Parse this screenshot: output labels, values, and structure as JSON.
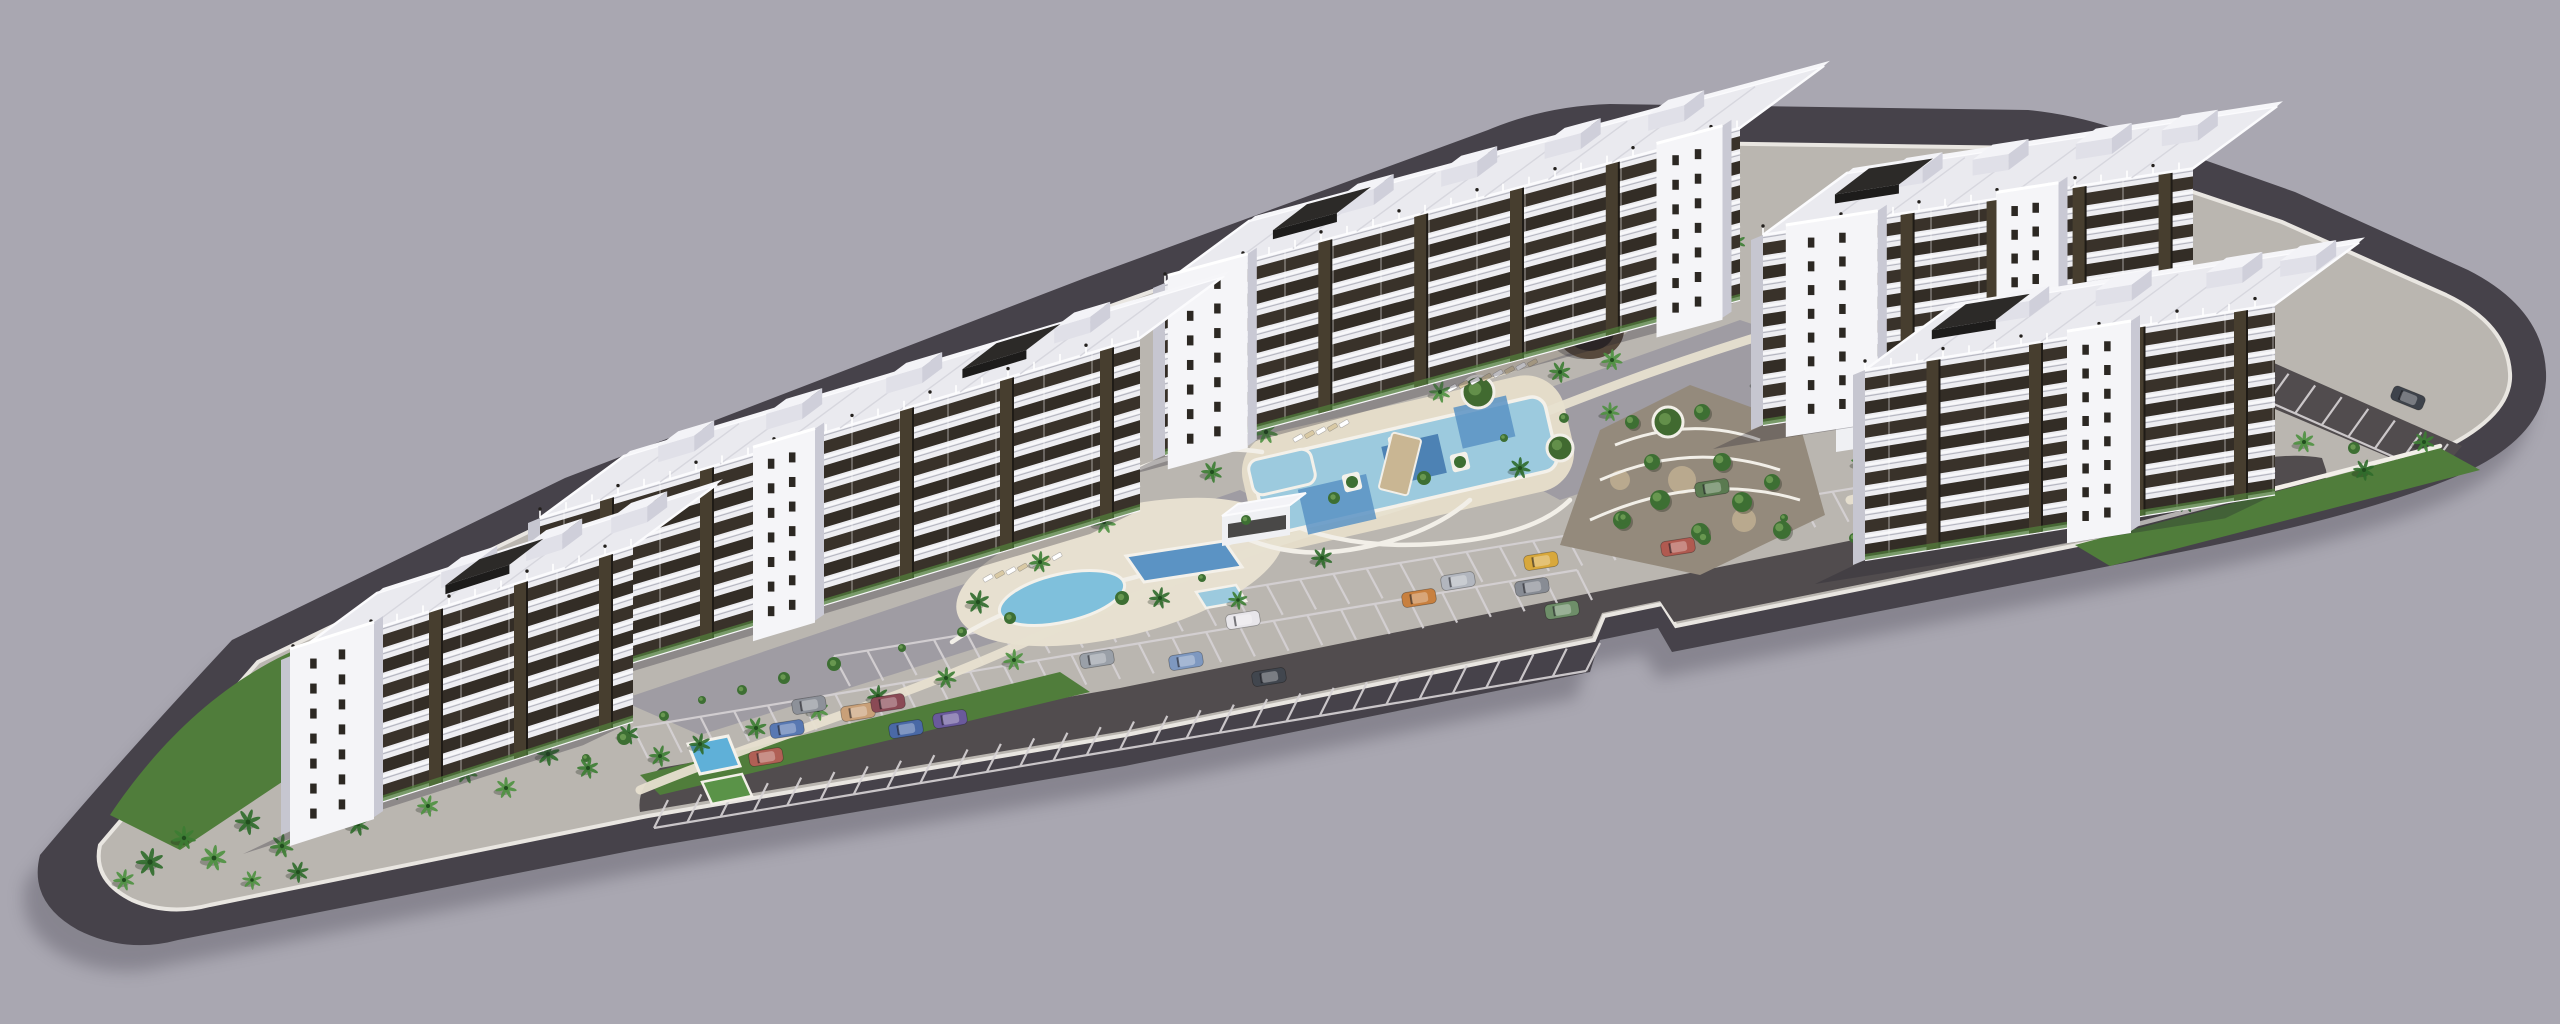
{
  "scene": {
    "description": "Aerial 3D architectural rendering of a coastal apartment complex: five white residential slab blocks arranged en echelon on an elongated triangular site with pools, palm gardens, a round gazebo, terraced landscaping and striped parking lots",
    "canvas": {
      "w": 2560,
      "h": 1024
    },
    "background": "#a9a7b1"
  },
  "colors": {
    "shadow": "#5e5b68",
    "road": "#46424a",
    "plate": "#bab6b0",
    "curb": "#e9e6e1",
    "parking": "#514c4e",
    "stall": "#d6d2d4",
    "plaza": "#9d9ba2",
    "green": "#507d3b",
    "green2": "#416a30",
    "deck": "#e7e0d0",
    "deck2": "#e4dcc9",
    "poolLight": "#9ccade",
    "poolMid": "#5b93c4",
    "poolDeep": "#3f76ad",
    "poolEdge": "#f4f1ea",
    "wallWhite": "#f2efe8",
    "gravel": "#948a7c",
    "gravelCircle": "#b9a98e",
    "facade": "#ededf1",
    "facadeSliver": "#c6c6d0",
    "window": "#39322a",
    "window2": "#332d26",
    "pier": "#473e2f",
    "pierEdge": "#1f1b16",
    "slab": "#f8f8fa",
    "roof": "#eaeaef",
    "roofLine": "#d4d4dc",
    "railing": "#fbfbfd",
    "boxTop": "#f3f3f7",
    "boxFront": "#e0e0e8",
    "boxSide": "#cfcfda",
    "pergola": "#2c2a28",
    "pergolaEdge": "#1d1c1b",
    "towerFace": "#f5f5f8",
    "towerSide": "#c9c9d4",
    "towerWin": "#2c2823",
    "gazebo1": "#57493c",
    "gazebo2": "#2e2823",
    "gazebo3": "#6b5b4a",
    "palm": [
      "#2f6b2b",
      "#3c7d33",
      "#4e9140"
    ],
    "palmCore": "#214d1e",
    "bush": "#3d6f33",
    "bushLight": "#7aa85c",
    "lounger1": "#ffffff",
    "lounger2": "#d9c9a4",
    "bridge": "#c9b693",
    "annexFace": "#eff0f3",
    "annexTop": "#e2e2e8",
    "annexWin": "#2c2a28",
    "court": "#5a9348",
    "courtPool": "#5fb0d8",
    "buildingShadow": "rgba(35,33,48,0.30)"
  },
  "site": {
    "outer": "M 40,855 Q 28,902 78,930 Q 126,954 178,940 L 645,848 L 1125,766 L 1590,672 L 1600,640 L 1658,628 L 1672,652 L 2140,560 Q 2352,520 2455,477 Q 2549,437 2546,372 Q 2543,308 2468,270 L 2295,192 L 2125,132 Q 2078,115 2028,110 L 1610,104 Q 1545,106 1488,130 L 1085,278 L 565,478 L 232,640 Q 118,762 40,855 Z",
    "inner": "M 100,845 Q 92,880 132,900 Q 168,916 210,905 L 648,816 L 1126,735 L 1594,640 L 1604,616 L 1662,604 L 1676,626 L 2142,532 Q 2342,494 2434,453 Q 2513,417 2510,373 Q 2507,324 2446,295 L 2282,222 L 2116,166 Q 2072,152 2030,148 L 1612,142 Q 1552,144 1498,167 L 1094,312 L 578,508 L 258,662 Q 162,772 100,845 Z",
    "shadowOffset": [
      -14,
      26
    ]
  },
  "parking": {
    "main": "M 640,812 L 1124,731 L 1592,636 L 1602,613 L 1660,601 L 1674,622 L 2140,528 L 2290,498 Q 2330,490 2326,470 L 2322,458 Q 2290,452 2240,462 L 2136,483 L 1670,577 L 1120,688 L 660,768 Q 636,788 640,812 Z",
    "corner": "M 2258,356 L 2462,446 L 2436,477 L 2230,390 Z",
    "rows": [
      {
        "x1": 850,
        "y1": 686,
        "x2": 2248,
        "y2": 456,
        "n": 43,
        "vx": -16,
        "vy": -30
      },
      {
        "x1": 648,
        "y1": 758,
        "x2": 1592,
        "y2": 600,
        "n": 29,
        "vx": -15,
        "vy": -30
      },
      {
        "x1": 668,
        "y1": 800,
        "x2": 1600,
        "y2": 643,
        "n": 29,
        "vx": -14,
        "vy": 28
      },
      {
        "x1": 2262,
        "y1": 362,
        "x2": 2448,
        "y2": 444,
        "n": 8,
        "vx": -20,
        "vy": 28
      }
    ]
  },
  "plaza": [
    "M620,700 L1080,545 L1240,490 L1300,520 L1050,625 L700,735 Z",
    "M1430,430 L1740,320 L1860,360 L1800,420 L1560,500 Z",
    "M1300,480 L1450,420 L1520,450 L1380,520 Z"
  ],
  "greens": [
    "M110,815 C160,740 230,672 320,640 L560,575 L620,600 L480,690 L300,770 L180,850 Z",
    "M640,775 L1060,672 L1090,692 L660,795 Z",
    "M2075,545 L2440,448 L2480,470 L2110,566 Z",
    "M320,770 L520,700 L560,720 L360,790 Z",
    "M600,620 L760,560 L800,580 L640,650 Z"
  ],
  "terracedGarden": {
    "blob": "M1560,545 L1600,430 L1690,385 L1800,425 L1825,515 L1700,575 Z",
    "arcs": [
      "M1590,520 Q1700,470 1800,500",
      "M1600,480 Q1690,440 1780,470",
      "M1615,445 Q1690,415 1760,440"
    ],
    "trees": [
      [
        1622,
        520,
        9
      ],
      [
        1660,
        500,
        10
      ],
      [
        1700,
        532,
        9
      ],
      [
        1742,
        502,
        10
      ],
      [
        1782,
        530,
        9
      ],
      [
        1652,
        462,
        8
      ],
      [
        1722,
        462,
        9
      ],
      [
        1772,
        482,
        8
      ],
      [
        1632,
        422,
        7
      ],
      [
        1702,
        412,
        8
      ]
    ],
    "gravelCircles": [
      [
        1682,
        480,
        14
      ],
      [
        1744,
        520,
        12
      ],
      [
        1620,
        480,
        10
      ]
    ]
  },
  "decks": [
    {
      "type": "ellipse",
      "cx": 1120,
      "cy": 572,
      "rx": 168,
      "ry": 64,
      "rot": -14
    },
    {
      "type": "rect",
      "cx": 1408,
      "cy": 462,
      "w": 330,
      "h": 118,
      "rot": -13,
      "rx": 40
    },
    {
      "type": "rect",
      "cx": 1548,
      "cy": 330,
      "w": 170,
      "h": 58,
      "rot": -18,
      "rx": 20
    }
  ],
  "paths": [
    "M640,790 C760,740 900,700 1030,640 C1130,596 1180,580 1240,556",
    "M1240,556 C1330,520 1380,520 1470,478",
    "M1500,430 C1600,390 1680,360 1780,330",
    "M1850,500 C1980,470 2120,450 2260,420",
    "M330,722 Q372,692 422,687",
    "M342,742 Q392,708 452,702"
  ],
  "walls": [
    "M952,642 Q1012,602 1092,587 Q1162,574 1232,542",
    "M1250,540 Q1300,560 1360,548 Q1430,535 1470,500",
    "M1130,472 Q1200,442 1262,452",
    "M1280,520 Q1360,556 1470,540 Q1540,530 1570,500",
    "M2076,540 L2440,446"
  ],
  "pools": {
    "lagoon": {
      "cx": 1405,
      "cy": 465,
      "w": 300,
      "h": 76,
      "rot": -13,
      "patches": [
        [
          1330,
          488,
          70,
          46
        ],
        [
          1415,
          462,
          58,
          40
        ],
        [
          1492,
          441,
          54,
          42
        ]
      ]
    },
    "arm": {
      "cx": 1282,
      "cy": 472,
      "w": 64,
      "h": 36,
      "rot": -13
    },
    "kidney": {
      "cx": 1062,
      "cy": 598,
      "rx": 64,
      "ry": 24,
      "rot": -13
    },
    "rectPool": {
      "o": [
        1126,
        556
      ],
      "a": [
        98,
        -15
      ],
      "b": [
        18,
        26
      ]
    },
    "kidsPool": {
      "o": [
        1196,
        592
      ],
      "a": [
        40,
        -7
      ],
      "b": [
        10,
        16
      ]
    },
    "lapPool": {
      "o": [
        688,
        744
      ],
      "a": [
        40,
        -8
      ],
      "b": [
        12,
        30
      ]
    },
    "court": {
      "o": [
        702,
        782
      ],
      "a": [
        40,
        -8
      ],
      "b": [
        10,
        22
      ]
    },
    "planters": [
      [
        1352,
        482
      ],
      [
        1398,
        444
      ],
      [
        1460,
        462
      ]
    ],
    "bridge": {
      "cx": 1400,
      "cy": 464,
      "w": 30,
      "h": 58,
      "rot": 14
    }
  },
  "pavilion": {
    "o": [
      1222,
      516
    ],
    "a": [
      68,
      -11
    ],
    "b": [
      16,
      -12
    ],
    "h": 30
  },
  "annex": {
    "face": "M1836,452 L2066,416 L2066,382 L1836,418 Z",
    "top": "M1836,418 L2066,382 L2082,370 L1852,406 Z",
    "winY": 424,
    "winX1": 1850,
    "winN": 6,
    "winStep": 36
  },
  "amphitheater": {
    "cx": 1512,
    "cy": 282,
    "r": 44,
    "arcs": [
      16,
      26,
      36
    ],
    "rot": -20
  },
  "gazebo": {
    "cx": 1590,
    "cy": 330,
    "rx": 34,
    "ry": 29
  },
  "planterCircles": [
    [
      1478,
      392,
      16
    ],
    [
      1560,
      448,
      13
    ],
    [
      1668,
      422,
      15
    ]
  ],
  "iso": {
    "depth": [
      84,
      -62
    ]
  },
  "buildings": [
    {
      "name": "block-4",
      "anchor": [
        1763,
        425
      ],
      "length": 430,
      "slope": 0.155,
      "height": 190,
      "floors": 8,
      "towers": [
        {
          "t": 0.06,
          "w": 92
        },
        {
          "t": 0.55,
          "w": 62
        }
      ],
      "pergolaT": 0.05,
      "boxes": [
        0.18,
        0.38,
        0.62,
        0.82
      ]
    },
    {
      "name": "block-5",
      "anchor": [
        1865,
        560
      ],
      "length": 410,
      "slope": 0.16,
      "height": 190,
      "floors": 8,
      "towers": [
        {
          "t": 0.5,
          "w": 64
        }
      ],
      "pergolaT": 0.04,
      "boxes": [
        0.2,
        0.45,
        0.72,
        0.9
      ]
    },
    {
      "name": "block-3",
      "anchor": [
        1165,
        455
      ],
      "length": 575,
      "slope": 0.27,
      "height": 172,
      "floors": 7,
      "towers": [
        {
          "t": 0.01,
          "w": 80
        },
        {
          "t": 0.86,
          "w": 66
        }
      ],
      "pergolaT": 0.1,
      "boxes": [
        0.22,
        0.4,
        0.58,
        0.76
      ]
    },
    {
      "name": "block-2",
      "anchor": [
        540,
        690
      ],
      "length": 600,
      "slope": 0.3,
      "height": 172,
      "floors": 7,
      "towers": [
        {
          "t": 0.36,
          "w": 62
        }
      ],
      "pergolaT": 0.62,
      "boxes": [
        0.12,
        0.3,
        0.5,
        0.78
      ]
    },
    {
      "name": "block-1",
      "anchor": [
        293,
        830
      ],
      "length": 340,
      "slope": 0.32,
      "height": 175,
      "floors": 7,
      "towers": [
        {
          "t": 0.0,
          "w": 84
        }
      ],
      "pergolaT": 0.3,
      "boxes": [
        0.3,
        0.55,
        0.8
      ]
    }
  ],
  "palms": [
    [
      150,
      862,
      13
    ],
    [
      184,
      838,
      11
    ],
    [
      214,
      858,
      12
    ],
    [
      248,
      822,
      12
    ],
    [
      282,
      846,
      11
    ],
    [
      318,
      802,
      12
    ],
    [
      358,
      824,
      11
    ],
    [
      392,
      788,
      12
    ],
    [
      428,
      806,
      10
    ],
    [
      298,
      872,
      10
    ],
    [
      466,
      772,
      11
    ],
    [
      506,
      788,
      10
    ],
    [
      548,
      754,
      11
    ],
    [
      588,
      768,
      10
    ],
    [
      124,
      880,
      10
    ],
    [
      628,
      734,
      10
    ],
    [
      660,
      756,
      10
    ],
    [
      252,
      880,
      9
    ],
    [
      700,
      744,
      10
    ],
    [
      756,
      728,
      10
    ],
    [
      818,
      710,
      10
    ],
    [
      878,
      696,
      10
    ],
    [
      946,
      678,
      10
    ],
    [
      1014,
      660,
      10
    ],
    [
      978,
      602,
      11
    ],
    [
      1040,
      562,
      10
    ],
    [
      1104,
      522,
      11
    ],
    [
      1160,
      598,
      10
    ],
    [
      1212,
      472,
      10
    ],
    [
      1266,
      432,
      11
    ],
    [
      1322,
      558,
      10
    ],
    [
      1238,
      600,
      9
    ],
    [
      1440,
      392,
      10
    ],
    [
      1520,
      468,
      10
    ],
    [
      1560,
      372,
      10
    ],
    [
      1610,
      412,
      9
    ],
    [
      1468,
      312,
      10
    ],
    [
      1548,
      262,
      10
    ],
    [
      1612,
      360,
      10
    ],
    [
      1666,
      300,
      10
    ],
    [
      1736,
      242,
      9
    ],
    [
      1788,
      228,
      9
    ],
    [
      1762,
      382,
      10
    ],
    [
      1862,
      462,
      10
    ],
    [
      1924,
      434,
      10
    ],
    [
      1992,
      472,
      10
    ],
    [
      2062,
      502,
      10
    ],
    [
      2124,
      472,
      10
    ],
    [
      2186,
      502,
      10
    ],
    [
      2246,
      472,
      10
    ],
    [
      2304,
      442,
      10
    ],
    [
      2364,
      470,
      10
    ],
    [
      2424,
      442,
      10
    ],
    [
      1980,
      302,
      9
    ],
    [
      2046,
      330,
      9
    ],
    [
      2108,
      302,
      9
    ]
  ],
  "bushes": [
    [
      702,
      700
    ],
    [
      742,
      690
    ],
    [
      784,
      678
    ],
    [
      834,
      664
    ],
    [
      902,
      648
    ],
    [
      962,
      632
    ],
    [
      1010,
      618
    ],
    [
      1122,
      598
    ],
    [
      1202,
      578
    ],
    [
      1246,
      520
    ],
    [
      1334,
      498
    ],
    [
      1424,
      478
    ],
    [
      1504,
      438
    ],
    [
      1564,
      418
    ],
    [
      1624,
      518
    ],
    [
      1704,
      538
    ],
    [
      1784,
      518
    ],
    [
      1854,
      538
    ],
    [
      1954,
      518
    ],
    [
      2054,
      508
    ],
    [
      2154,
      488
    ],
    [
      2254,
      458
    ],
    [
      2354,
      448
    ],
    [
      624,
      738
    ],
    [
      586,
      758
    ],
    [
      664,
      716
    ]
  ],
  "loungerRows": [
    {
      "x": 1432,
      "y": 358,
      "n": 10
    },
    {
      "x": 1452,
      "y": 388,
      "n": 8
    },
    {
      "x": 1298,
      "y": 438,
      "n": 5
    },
    {
      "x": 1004,
      "y": 546,
      "n": 7
    },
    {
      "x": 988,
      "y": 578,
      "n": 7
    },
    {
      "x": 1545,
      "y": 318,
      "n": 6
    },
    {
      "x": 2090,
      "y": 420,
      "n": 5
    }
  ],
  "cars": [
    {
      "x": 766,
      "y": 757,
      "a": -9,
      "c": "#b06055"
    },
    {
      "x": 787,
      "y": 729,
      "a": -9,
      "c": "#5878b2"
    },
    {
      "x": 809,
      "y": 705,
      "a": -9,
      "c": "#8d9199"
    },
    {
      "x": 858,
      "y": 712,
      "a": -9,
      "c": "#c9a078"
    },
    {
      "x": 888,
      "y": 703,
      "a": -9,
      "c": "#8a4a55"
    },
    {
      "x": 906,
      "y": 729,
      "a": -9,
      "c": "#4a69a6"
    },
    {
      "x": 950,
      "y": 719,
      "a": -9,
      "c": "#6a5a9c"
    },
    {
      "x": 1097,
      "y": 659,
      "a": -9,
      "c": "#9aa0a8"
    },
    {
      "x": 1186,
      "y": 661,
      "a": -9,
      "c": "#7e98c0"
    },
    {
      "x": 1243,
      "y": 620,
      "a": -9,
      "c": "#e8e6ea"
    },
    {
      "x": 1269,
      "y": 677,
      "a": -9,
      "c": "#41464e"
    },
    {
      "x": 1419,
      "y": 598,
      "a": -9,
      "c": "#c8803f"
    },
    {
      "x": 1458,
      "y": 581,
      "a": -9,
      "c": "#b2b6be"
    },
    {
      "x": 1532,
      "y": 587,
      "a": -9,
      "c": "#888c94"
    },
    {
      "x": 1541,
      "y": 561,
      "a": -9,
      "c": "#d8a83c"
    },
    {
      "x": 1562,
      "y": 610,
      "a": -9,
      "c": "#6e8e69"
    },
    {
      "x": 1678,
      "y": 547,
      "a": -9,
      "c": "#b05a50"
    },
    {
      "x": 1712,
      "y": 488,
      "a": -9,
      "c": "#5a7a50"
    },
    {
      "x": 2408,
      "y": 398,
      "a": 22,
      "c": "#3e434b"
    }
  ]
}
